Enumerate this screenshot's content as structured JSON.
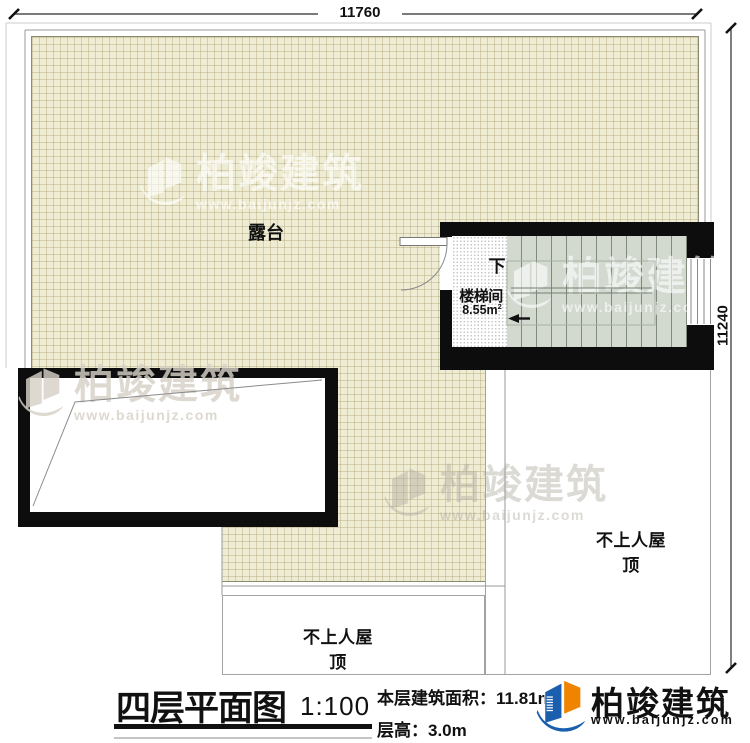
{
  "dimensions": {
    "top": "11760",
    "right": "11240"
  },
  "plan": {
    "terrace_label": "露台",
    "stairwell": {
      "name": "楼梯间",
      "area": "8.55m",
      "area_sup": "2",
      "direction": "下"
    },
    "roof_right_label": "不上人屋顶",
    "roof_bottom_label": "不上人屋顶"
  },
  "title_block": {
    "title": "四层平面图",
    "scale": "1:100",
    "area_label": "本层建筑面积：",
    "area_value": "11.81m",
    "area_sup": "2",
    "height_label": "层高：",
    "height_value": "3.0m"
  },
  "brand": {
    "name": "柏竣建筑",
    "url": "www.baijunjz.com"
  },
  "watermark": {
    "name": "柏竣建筑",
    "url": "www.baijunjz.com"
  },
  "colors": {
    "wall": "#0d0d0d",
    "terrace_fill": "#efecd4",
    "stair_fill": "#d3d9cf",
    "brand_blue": "#1a5fae",
    "brand_orange": "#f08300"
  }
}
